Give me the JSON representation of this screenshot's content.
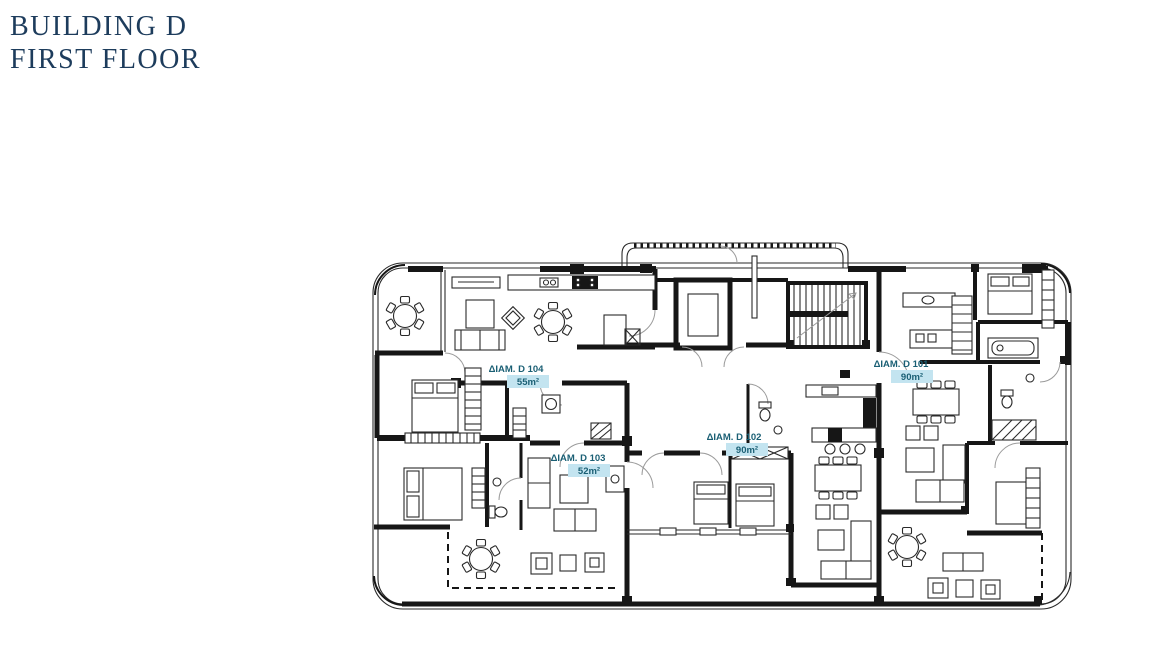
{
  "title": {
    "line1": "BUILDING D",
    "line2": "FIRST FLOOR",
    "color": "#1d3c5c"
  },
  "floorplan": {
    "apartments": [
      {
        "id": "D104",
        "label": "ΔΙΑΜ. D 104",
        "area": "55m²"
      },
      {
        "id": "D103",
        "label": "ΔΙΑΜ. D 103",
        "area": "52m²"
      },
      {
        "id": "D102",
        "label": "ΔΙΑΜ. D 102",
        "area": "90m²"
      },
      {
        "id": "D101",
        "label": "ΔΙΑΜ. D 101",
        "area": "90m²"
      }
    ],
    "label_color": "#1a5f74",
    "area_highlight": "#c3e4f0",
    "line_color": "#161616",
    "background": "#ffffff",
    "core_elements": [
      "elevator",
      "staircase",
      "corridor"
    ]
  }
}
